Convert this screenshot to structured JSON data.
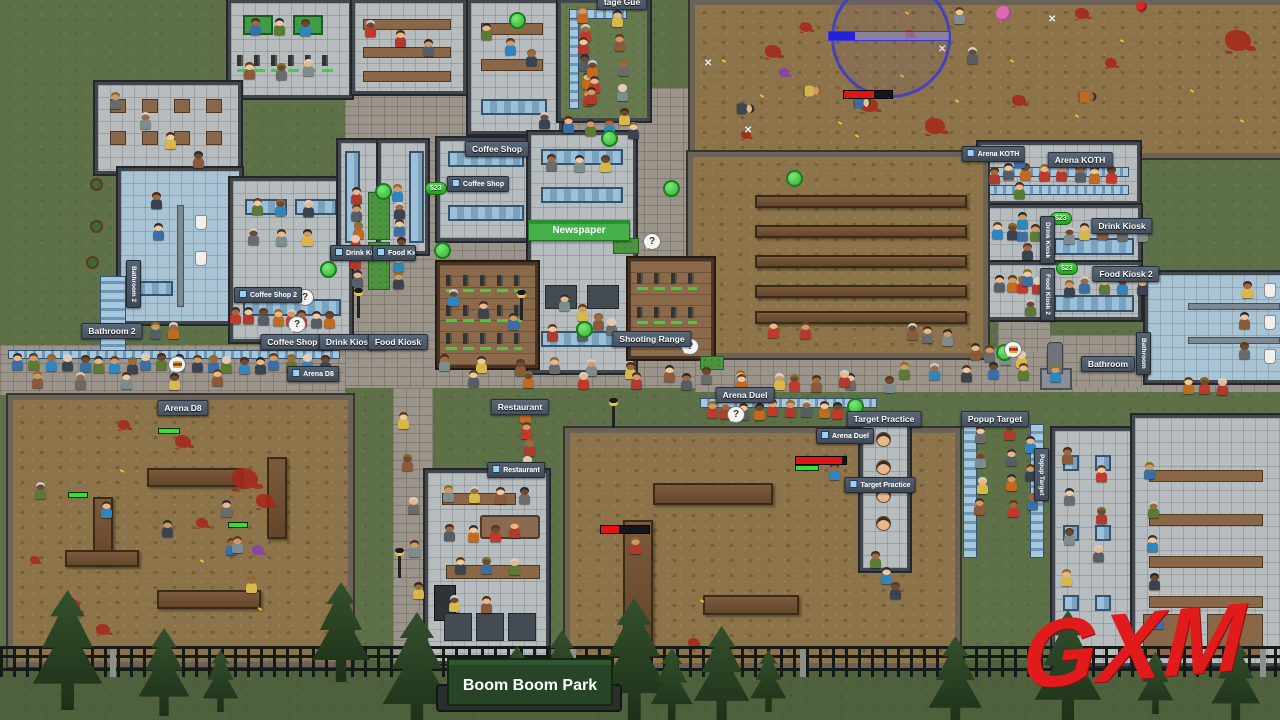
{
  "meta": {
    "park_name": "Boom Boom Park",
    "watermark": "GXM"
  },
  "ui": {
    "question_mark": "?",
    "money_popup": "$23",
    "x_mark": "✕",
    "partial_top_label": "tage Gue"
  },
  "venues": {
    "arena_koth": "Arena KOTH",
    "drink_kiosk": "Drink Kiosk",
    "food_kiosk_2": "Food Kiosk 2",
    "bathroom": "Bathroom",
    "bathroom_2": "Bathroom 2",
    "coffee_shop": "Coffee Shop",
    "coffee_shop_2": "Coffee Shop 2",
    "drink_kiosk_2": "Drink Kiosk 2",
    "food_kiosk": "Food Kiosk",
    "newspaper": "Newspaper",
    "shooting_range": "Shooting Range",
    "arena_d8": "Arena D8",
    "restaurant": "Restaurant",
    "arena_duel": "Arena Duel",
    "target_practice": "Target Practice",
    "popup_target": "Popup Target"
  },
  "koth": {
    "progress": 0.22
  },
  "people": [
    {
      "x": 14,
      "y": 362,
      "dx": 16,
      "dy": 0,
      "n": 20
    },
    {
      "x": 30,
      "y": 378,
      "dx": 46,
      "dy": 0,
      "n": 5
    },
    {
      "x": 232,
      "y": 316,
      "dx": 13,
      "dy": 0,
      "n": 8
    },
    {
      "x": 250,
      "y": 205,
      "dx": 26,
      "dy": 0,
      "n": 3
    },
    {
      "x": 250,
      "y": 237,
      "dx": 26,
      "dy": 0,
      "n": 3
    },
    {
      "x": 352,
      "y": 193,
      "dx": 0,
      "dy": 17,
      "n": 6
    },
    {
      "x": 394,
      "y": 193,
      "dx": 0,
      "dy": 17,
      "n": 6
    },
    {
      "x": 440,
      "y": 360,
      "dx": 37,
      "dy": 2,
      "n": 13
    },
    {
      "x": 470,
      "y": 379,
      "dx": 53,
      "dy": 0,
      "n": 8
    },
    {
      "x": 540,
      "y": 118,
      "dx": 22,
      "dy": 3,
      "n": 5
    },
    {
      "x": 612,
      "y": 18,
      "dx": 2,
      "dy": 24,
      "n": 5
    },
    {
      "x": 578,
      "y": 12,
      "dx": 1,
      "dy": 17,
      "n": 6
    },
    {
      "x": 250,
      "y": 26,
      "dx": 24,
      "dy": 0,
      "n": 3
    },
    {
      "x": 245,
      "y": 68,
      "dx": 30,
      "dy": 0,
      "n": 3
    },
    {
      "x": 365,
      "y": 28,
      "dx": 28,
      "dy": 9,
      "n": 3
    },
    {
      "x": 480,
      "y": 28,
      "dx": 24,
      "dy": 15,
      "n": 3
    },
    {
      "x": 110,
      "y": 100,
      "dx": 28,
      "dy": 19,
      "n": 4
    },
    {
      "x": 988,
      "y": 172,
      "dx": 17,
      "dy": 0,
      "n": 8
    },
    {
      "x": 992,
      "y": 230,
      "dx": 13,
      "dy": 0,
      "n": 4
    },
    {
      "x": 1063,
      "y": 232,
      "dx": 18,
      "dy": 0,
      "n": 5
    },
    {
      "x": 992,
      "y": 282,
      "dx": 13,
      "dy": 0,
      "n": 4
    },
    {
      "x": 1063,
      "y": 285,
      "dx": 18,
      "dy": 0,
      "n": 5
    },
    {
      "x": 1240,
      "y": 288,
      "dx": 0,
      "dy": 30,
      "n": 3
    },
    {
      "x": 1185,
      "y": 386,
      "dx": 16,
      "dy": 0,
      "n": 3
    },
    {
      "x": 1012,
      "y": 158,
      "dx": 3,
      "dy": 30,
      "n": 6
    },
    {
      "x": 972,
      "y": 352,
      "dx": 14,
      "dy": 2,
      "n": 4
    },
    {
      "x": 705,
      "y": 408,
      "dx": 16,
      "dy": 0,
      "n": 10
    },
    {
      "x": 872,
      "y": 560,
      "dx": 9,
      "dy": 15,
      "n": 3
    },
    {
      "x": 976,
      "y": 432,
      "dx": 0,
      "dy": 25,
      "n": 4
    },
    {
      "x": 1006,
      "y": 432,
      "dx": 0,
      "dy": 25,
      "n": 4
    },
    {
      "x": 1026,
      "y": 442,
      "dx": 0,
      "dy": 28,
      "n": 3
    },
    {
      "x": 445,
      "y": 494,
      "dx": 24,
      "dy": 0,
      "n": 4
    },
    {
      "x": 445,
      "y": 530,
      "dx": 22,
      "dy": 0,
      "n": 4
    },
    {
      "x": 455,
      "y": 565,
      "dx": 26,
      "dy": 0,
      "n": 3
    },
    {
      "x": 450,
      "y": 601,
      "dx": 30,
      "dy": 0,
      "n": 2
    },
    {
      "x": 520,
      "y": 414,
      "dx": 1,
      "dy": 16,
      "n": 4
    },
    {
      "x": 1145,
      "y": 468,
      "dx": 2,
      "dy": 38,
      "n": 5
    },
    {
      "x": 1062,
      "y": 455,
      "dx": 0,
      "dy": 40,
      "n": 4
    },
    {
      "x": 1095,
      "y": 470,
      "dx": 0,
      "dy": 42,
      "n": 3
    },
    {
      "x": 35,
      "y": 490,
      "dx": 64,
      "dy": 18,
      "n": 4
    },
    {
      "x": 220,
      "y": 505,
      "dx": 14,
      "dy": 40,
      "n": 3
    },
    {
      "x": 630,
      "y": 545,
      "n": 1
    },
    {
      "x": 828,
      "y": 468,
      "n": 1
    },
    {
      "x": 952,
      "y": 14,
      "n": 1
    },
    {
      "x": 966,
      "y": 52,
      "n": 1
    },
    {
      "x": 735,
      "y": 104,
      "n": 1,
      "lying": 1
    },
    {
      "x": 806,
      "y": 88,
      "n": 1,
      "lying": 1
    },
    {
      "x": 1077,
      "y": 92,
      "n": 1,
      "lying": 1
    },
    {
      "x": 856,
      "y": 100,
      "n": 1,
      "lying": 1
    },
    {
      "x": 905,
      "y": 330,
      "dx": 18,
      "dy": 2,
      "n": 3
    },
    {
      "x": 770,
      "y": 330,
      "dx": 30,
      "dy": 0,
      "n": 2
    },
    {
      "x": 900,
      "y": 368,
      "dx": 30,
      "dy": 1,
      "n": 6
    },
    {
      "x": 548,
      "y": 163,
      "dx": 26,
      "dy": 0,
      "n": 3
    },
    {
      "x": 548,
      "y": 330,
      "dx": 30,
      "dy": 0,
      "n": 2
    },
    {
      "x": 450,
      "y": 298,
      "dx": 28,
      "dy": 11,
      "n": 3
    },
    {
      "x": 560,
      "y": 300,
      "dx": 16,
      "dy": 9,
      "n": 4
    },
    {
      "x": 150,
      "y": 330,
      "dx": 18,
      "dy": 0,
      "n": 2
    },
    {
      "x": 152,
      "y": 198,
      "dx": 0,
      "dy": 30,
      "n": 2
    },
    {
      "x": 398,
      "y": 420,
      "dx": 4,
      "dy": 42,
      "n": 5
    },
    {
      "x": 588,
      "y": 66,
      "dx": 0,
      "dy": 15,
      "n": 3
    }
  ],
  "decor": {
    "targets": [
      {
        "x": 876,
        "y": 432
      },
      {
        "x": 876,
        "y": 460
      },
      {
        "x": 876,
        "y": 488
      },
      {
        "x": 876,
        "y": 516
      }
    ],
    "splats": [
      {
        "x": 765,
        "y": 45,
        "s": 16
      },
      {
        "x": 800,
        "y": 22,
        "s": 12
      },
      {
        "x": 925,
        "y": 118,
        "s": 20
      },
      {
        "x": 1012,
        "y": 95,
        "s": 14
      },
      {
        "x": 1105,
        "y": 58,
        "s": 12
      },
      {
        "x": 1225,
        "y": 30,
        "s": 26
      },
      {
        "x": 741,
        "y": 131,
        "s": 10
      },
      {
        "x": 1075,
        "y": 8,
        "s": 14
      },
      {
        "x": 860,
        "y": 98,
        "s": 18
      },
      {
        "x": 779,
        "y": 68,
        "s": 11,
        "c": "#8a3fae"
      },
      {
        "x": 175,
        "y": 435,
        "s": 16
      },
      {
        "x": 232,
        "y": 468,
        "s": 26
      },
      {
        "x": 256,
        "y": 494,
        "s": 18
      },
      {
        "x": 196,
        "y": 518,
        "s": 12
      },
      {
        "x": 60,
        "y": 598,
        "s": 20
      },
      {
        "x": 96,
        "y": 624,
        "s": 14
      },
      {
        "x": 30,
        "y": 556,
        "s": 10
      },
      {
        "x": 252,
        "y": 545,
        "s": 12,
        "c": "#8a3fae"
      },
      {
        "x": 688,
        "y": 638,
        "s": 12
      },
      {
        "x": 640,
        "y": 650,
        "s": 10
      },
      {
        "x": 118,
        "y": 420,
        "s": 12
      },
      {
        "x": 905,
        "y": 30,
        "s": 10
      }
    ],
    "casings": [
      {
        "x": 722,
        "y": 60
      },
      {
        "x": 760,
        "y": 95
      },
      {
        "x": 838,
        "y": 122
      },
      {
        "x": 900,
        "y": 75
      },
      {
        "x": 955,
        "y": 100
      },
      {
        "x": 1010,
        "y": 60
      },
      {
        "x": 1075,
        "y": 115
      },
      {
        "x": 1120,
        "y": 40
      },
      {
        "x": 1190,
        "y": 90
      },
      {
        "x": 1240,
        "y": 120
      },
      {
        "x": 905,
        "y": 12
      },
      {
        "x": 855,
        "y": 135
      },
      {
        "x": 120,
        "y": 470
      },
      {
        "x": 258,
        "y": 608
      },
      {
        "x": 200,
        "y": 560
      },
      {
        "x": 700,
        "y": 600
      }
    ],
    "xmarks": [
      {
        "x": 704,
        "y": 58
      },
      {
        "x": 744,
        "y": 125
      },
      {
        "x": 938,
        "y": 44
      },
      {
        "x": 1048,
        "y": 14
      }
    ],
    "balls": [
      {
        "x": 996,
        "y": 6,
        "s": 15,
        "c": "#df6ab2"
      },
      {
        "x": 1136,
        "y": 1,
        "s": 11,
        "c": "#d02a2a"
      }
    ],
    "trees": [
      {
        "x": 28,
        "y": 590,
        "h": 120
      },
      {
        "x": 135,
        "y": 628,
        "h": 88
      },
      {
        "x": 200,
        "y": 650,
        "h": 62
      },
      {
        "x": 308,
        "y": 582,
        "h": 100
      },
      {
        "x": 378,
        "y": 612,
        "h": 118
      },
      {
        "x": 498,
        "y": 646,
        "h": 58
      },
      {
        "x": 535,
        "y": 630,
        "h": 82
      },
      {
        "x": 594,
        "y": 598,
        "h": 122
      },
      {
        "x": 648,
        "y": 648,
        "h": 72
      },
      {
        "x": 690,
        "y": 626,
        "h": 96
      },
      {
        "x": 748,
        "y": 650,
        "h": 62
      },
      {
        "x": 925,
        "y": 636,
        "h": 92
      },
      {
        "x": 1030,
        "y": 610,
        "h": 115
      },
      {
        "x": 1135,
        "y": 652,
        "h": 62
      },
      {
        "x": 1208,
        "y": 638,
        "h": 84
      }
    ],
    "lamps": [
      {
        "x": 357,
        "y": 296
      },
      {
        "x": 520,
        "y": 298
      },
      {
        "x": 612,
        "y": 406
      },
      {
        "x": 398,
        "y": 556
      }
    ],
    "bubbles": [
      {
        "t": "g",
        "x": 509,
        "y": 12
      },
      {
        "t": "g",
        "x": 601,
        "y": 130
      },
      {
        "t": "g",
        "x": 786,
        "y": 170
      },
      {
        "t": "g",
        "x": 434,
        "y": 242
      },
      {
        "t": "g",
        "x": 375,
        "y": 183
      },
      {
        "t": "g",
        "x": 320,
        "y": 261
      },
      {
        "t": "g",
        "x": 576,
        "y": 321
      },
      {
        "t": "g",
        "x": 847,
        "y": 398
      },
      {
        "t": "g",
        "x": 996,
        "y": 344
      },
      {
        "t": "g",
        "x": 663,
        "y": 180
      },
      {
        "t": "q",
        "x": 643,
        "y": 233
      },
      {
        "t": "q",
        "x": 681,
        "y": 338
      },
      {
        "t": "q",
        "x": 727,
        "y": 406
      },
      {
        "t": "q",
        "x": 296,
        "y": 289
      },
      {
        "t": "q",
        "x": 288,
        "y": 316
      },
      {
        "t": "b",
        "x": 168,
        "y": 356
      },
      {
        "t": "b",
        "x": 1004,
        "y": 341
      }
    ],
    "pills": [
      {
        "x": 425,
        "y": 182
      },
      {
        "x": 1050,
        "y": 212
      },
      {
        "x": 1056,
        "y": 262
      }
    ],
    "healthbars": [
      {
        "x": 843,
        "y": 90,
        "w": 48,
        "fill": 0.62
      },
      {
        "x": 795,
        "y": 456,
        "w": 50,
        "fill": 0.92
      },
      {
        "x": 600,
        "y": 525,
        "w": 48,
        "fill": 0.38
      }
    ],
    "greenbars": [
      {
        "x": 795,
        "y": 465,
        "w": 22
      },
      {
        "x": 158,
        "y": 428,
        "w": 20
      },
      {
        "x": 68,
        "y": 492,
        "w": 18
      },
      {
        "x": 228,
        "y": 522,
        "w": 18
      }
    ]
  }
}
